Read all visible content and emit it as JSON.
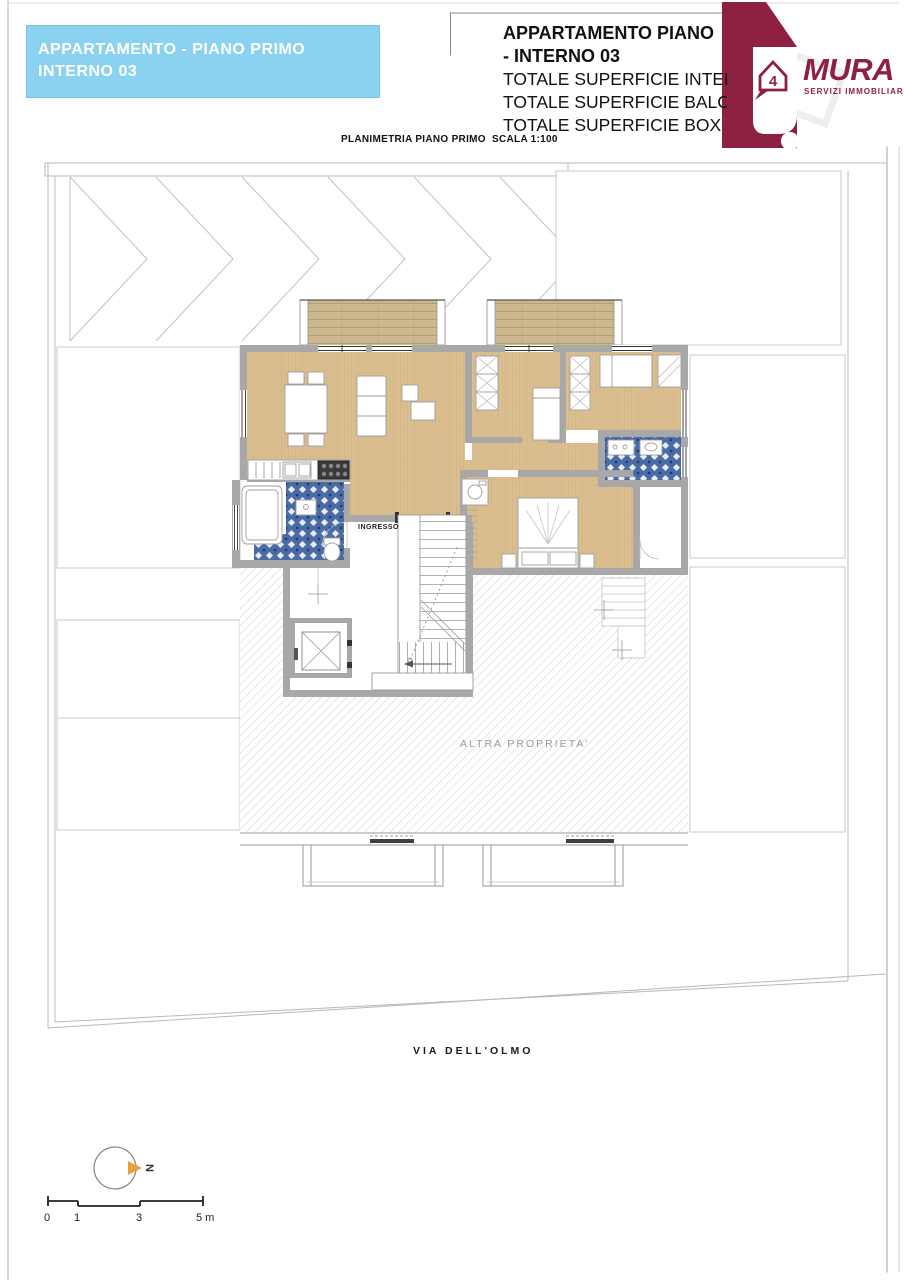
{
  "page": {
    "header_left": {
      "line1": "APPARTAMENTO - PIANO PRIMO",
      "line2": "INTERNO 03"
    },
    "header_right": {
      "title_line1": "APPARTAMENTO PIANO",
      "title_line2": "- INTERNO 03",
      "detail_lines": [
        "TOTALE SUPERFICIE INTER",
        "TOTALE SUPERFICIE BALC",
        "TOTALE SUPERFICIE BOX"
      ]
    },
    "subtitle": "PLANIMETRIA PIANO PRIMO  SCALA 1:100",
    "logo": {
      "brand": "MURA",
      "tagline": "SERVIZI IMMOBILIARI",
      "badge_number": "4"
    },
    "plan": {
      "entrance_label": "INGRESSO",
      "other_property_label": "ALTRA PROPRIETA'",
      "street_label": "VIA DELL'OLMO",
      "compass_letter": "N"
    },
    "scalebar": {
      "ticks": [
        "0",
        "1",
        "3",
        "5 m"
      ]
    },
    "colors": {
      "accent_cyan": "#8BD1F0",
      "brand_maroon": "#8E2042",
      "wood_floor": "#DBBE90",
      "deck_wood": "#CDB78F",
      "tile_blue": "#4A6BA6",
      "wall_grey": "#A8A8A8",
      "hatch_grey": "#CDCDCD",
      "north_orange": "#E8A23C"
    }
  }
}
